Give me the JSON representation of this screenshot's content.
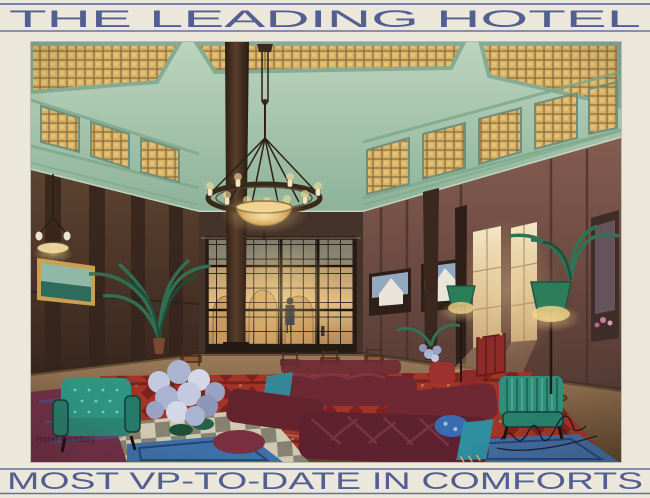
{
  "postcard": {
    "top_banner": {
      "text": "THE LEADING HOTEL"
    },
    "bottom_banner": {
      "text": "MOST VP-TO-DATE IN COMFORTS"
    },
    "corner_caption": "Hotel Bombay",
    "colors": {
      "paper": "#ebe7da",
      "ink": "#47538c",
      "rule": "#6570a2"
    }
  },
  "scene": {
    "setting": "grand hotel lounge interior, watercolour rendering",
    "elements": [
      "coffered-skylight-ceiling",
      "stained-glass-clerestory",
      "bronze-ring-chandelier",
      "pendant-lamp",
      "glazed-screen-to-lit-hall",
      "standing-figure",
      "palm-plants",
      "hydrangea-bouquet",
      "oriental-red-carpet",
      "maroon-lounge-sofas",
      "teal-tufted-armchair",
      "green-striped-armchair",
      "green-shaded-floor-lamps",
      "landscape-paintings",
      "tall-sunlit-windows",
      "marble-checker-floor",
      "blue-rugs",
      "artist-signature-illegible"
    ],
    "colors": {
      "ceiling_celadon": "#a6c3ad",
      "skylight_amber": "#d8b164",
      "wall_wood_dark": "#53382e",
      "wall_mauve": "#77524a",
      "window_glow": "#e7c68c",
      "carpet_red": "#a23527",
      "sofa_maroon": "#6e2833",
      "chair_teal": "#2f9482",
      "lamp_green": "#2e7d5a",
      "rug_blue": "#3f6fa8",
      "floor_marble": "#cfc8b2"
    }
  }
}
